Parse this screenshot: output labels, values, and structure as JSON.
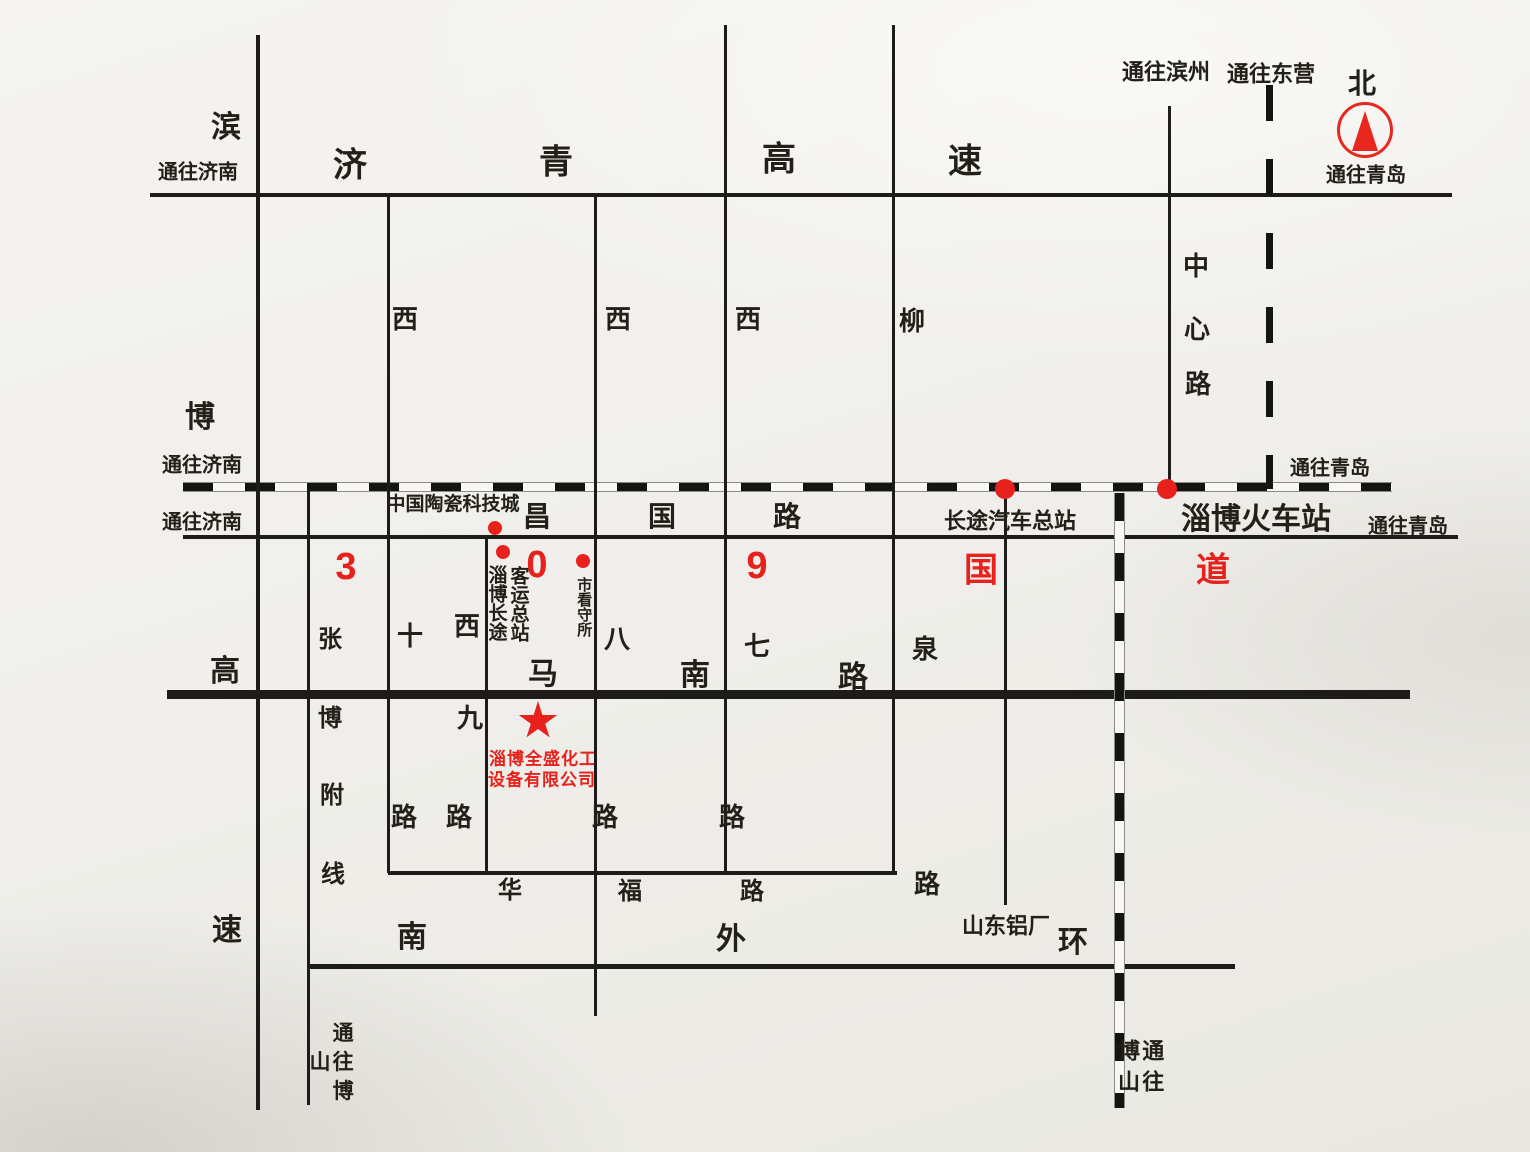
{
  "meta": {
    "title": "淄博全盛化工设备有限公司 位置示意图",
    "type": "location-sketch-map"
  },
  "palette": {
    "line": "#1d1c1a",
    "red": "#e8211d",
    "background": "#f0efeb"
  },
  "compass": {
    "label": "北",
    "x": 1365,
    "y": 130,
    "r": 27
  },
  "roads": {
    "horizontal": [
      {
        "n": "jiqing-expressway",
        "y": 195,
        "x1": 150,
        "x2": 1452,
        "th": 4
      },
      {
        "n": "railway-g309",
        "y": 486,
        "x1": 183,
        "x2": 1392,
        "th": 8,
        "style": "railway"
      },
      {
        "n": "changguo-road",
        "y": 537,
        "x1": 183,
        "x2": 1458,
        "th": 4
      },
      {
        "n": "manan-road",
        "y": 694,
        "x1": 167,
        "x2": 1410,
        "th": 9
      },
      {
        "n": "huafu-road",
        "y": 873,
        "x1": 388,
        "x2": 897,
        "th": 4
      },
      {
        "n": "south-outer-ring",
        "y": 966,
        "x1": 308,
        "x2": 1235,
        "th": 5
      }
    ],
    "vertical": [
      {
        "n": "binbo-expressway",
        "x": 258,
        "y1": 35,
        "y2": 1110,
        "th": 4
      },
      {
        "n": "zhangbo-branch-line",
        "x": 308,
        "y1": 489,
        "y2": 1105,
        "th": 3
      },
      {
        "n": "west-10th-road",
        "x": 388,
        "y1": 195,
        "y2": 873,
        "th": 3
      },
      {
        "n": "west-9th-road",
        "x": 486,
        "y1": 537,
        "y2": 873,
        "th": 3
      },
      {
        "n": "west-8th-road",
        "x": 595,
        "y1": 195,
        "y2": 1016,
        "th": 3
      },
      {
        "n": "west-7th-road",
        "x": 725,
        "y1": 25,
        "y2": 873,
        "th": 3
      },
      {
        "n": "liuquan-road",
        "x": 893,
        "y1": 25,
        "y2": 875,
        "th": 3
      },
      {
        "n": "bus-terminal-spur",
        "x": 1005,
        "y1": 489,
        "y2": 905,
        "th": 3
      },
      {
        "n": "zhongxin-road",
        "x": 1169,
        "y1": 106,
        "y2": 489,
        "th": 3
      },
      {
        "n": "railway-south",
        "x": 1118,
        "y1": 493,
        "y2": 1108,
        "th": 9,
        "style": "railway"
      },
      {
        "n": "dongying-road",
        "x": 1269,
        "y1": 85,
        "y2": 489,
        "th": 7,
        "style": "dashed"
      }
    ]
  },
  "labels": [
    {
      "t": "通往济南",
      "x": 198,
      "y": 173,
      "s": 20,
      "n": "to-jinan-north"
    },
    {
      "t": "滨",
      "x": 226,
      "y": 128,
      "s": 30,
      "n": "binbo-expwy-char-1"
    },
    {
      "t": "博",
      "x": 200,
      "y": 418,
      "s": 30,
      "n": "binbo-expwy-char-2"
    },
    {
      "t": "高",
      "x": 225,
      "y": 672,
      "s": 30,
      "n": "binbo-expwy-char-3"
    },
    {
      "t": "速",
      "x": 227,
      "y": 931,
      "s": 30,
      "n": "binbo-expwy-char-4"
    },
    {
      "t": "济",
      "x": 350,
      "y": 166,
      "s": 34,
      "n": "jiqing-expwy-char-1"
    },
    {
      "t": "青",
      "x": 556,
      "y": 163,
      "s": 34,
      "n": "jiqing-expwy-char-2"
    },
    {
      "t": "高",
      "x": 779,
      "y": 160,
      "s": 34,
      "n": "jiqing-expwy-char-3"
    },
    {
      "t": "速",
      "x": 965,
      "y": 162,
      "s": 34,
      "n": "jiqing-expwy-char-4"
    },
    {
      "t": "通往滨州",
      "x": 1166,
      "y": 72,
      "s": 22,
      "n": "to-binzhou"
    },
    {
      "t": "通往东营",
      "x": 1271,
      "y": 74,
      "s": 22,
      "n": "to-dongying"
    },
    {
      "t": "北",
      "x": 1362,
      "y": 84,
      "s": 28,
      "n": "north-label"
    },
    {
      "t": "通往青岛",
      "x": 1366,
      "y": 176,
      "s": 20,
      "n": "to-qingdao-top"
    },
    {
      "t": "西",
      "x": 405,
      "y": 320,
      "s": 26,
      "n": "west10-char-xi"
    },
    {
      "t": "十",
      "x": 410,
      "y": 637,
      "s": 26,
      "n": "west10-char-shi"
    },
    {
      "t": "路",
      "x": 404,
      "y": 818,
      "s": 26,
      "n": "west10-char-lu"
    },
    {
      "t": "西",
      "x": 467,
      "y": 627,
      "s": 26,
      "n": "west9-char-xi"
    },
    {
      "t": "九",
      "x": 470,
      "y": 719,
      "s": 26,
      "n": "west9-char-jiu"
    },
    {
      "t": "路",
      "x": 459,
      "y": 818,
      "s": 26,
      "n": "west9-char-lu"
    },
    {
      "t": "西",
      "x": 618,
      "y": 320,
      "s": 26,
      "n": "west8-char-xi"
    },
    {
      "t": "八",
      "x": 617,
      "y": 640,
      "s": 26,
      "n": "west8-char-ba"
    },
    {
      "t": "路",
      "x": 605,
      "y": 818,
      "s": 26,
      "n": "west8-char-lu"
    },
    {
      "t": "西",
      "x": 748,
      "y": 320,
      "s": 26,
      "n": "west7-char-xi"
    },
    {
      "t": "七",
      "x": 757,
      "y": 647,
      "s": 26,
      "n": "west7-char-qi"
    },
    {
      "t": "路",
      "x": 732,
      "y": 818,
      "s": 26,
      "n": "west7-char-lu"
    },
    {
      "t": "柳",
      "x": 912,
      "y": 322,
      "s": 26,
      "n": "liuquan-char-liu"
    },
    {
      "t": "泉",
      "x": 925,
      "y": 650,
      "s": 26,
      "n": "liuquan-char-quan"
    },
    {
      "t": "路",
      "x": 927,
      "y": 885,
      "s": 26,
      "n": "liuquan-char-lu"
    },
    {
      "t": "中",
      "x": 1196,
      "y": 267,
      "s": 26,
      "n": "zhongxin-char-1"
    },
    {
      "t": "心",
      "x": 1197,
      "y": 330,
      "s": 26,
      "n": "zhongxin-char-2"
    },
    {
      "t": "路",
      "x": 1198,
      "y": 385,
      "s": 26,
      "n": "zhongxin-char-3"
    },
    {
      "t": "通往济南",
      "x": 202,
      "y": 466,
      "s": 20,
      "n": "to-jinan-railway"
    },
    {
      "t": "通往济南",
      "x": 202,
      "y": 523,
      "s": 20,
      "n": "to-jinan-changguo"
    },
    {
      "t": "通往青岛",
      "x": 1330,
      "y": 469,
      "s": 20,
      "n": "to-qingdao-railway"
    },
    {
      "t": "通往青岛",
      "x": 1408,
      "y": 527,
      "s": 20,
      "n": "to-qingdao-changguo"
    },
    {
      "t": "中国陶瓷科技城",
      "x": 453,
      "y": 505,
      "s": 19,
      "n": "ceramics-city-label"
    },
    {
      "t": "昌",
      "x": 537,
      "y": 517,
      "s": 28,
      "n": "changguo-char-1"
    },
    {
      "t": "国",
      "x": 662,
      "y": 517,
      "s": 28,
      "n": "changguo-char-2"
    },
    {
      "t": "路",
      "x": 787,
      "y": 517,
      "s": 28,
      "n": "changguo-char-3"
    },
    {
      "t": "长途汽车总站",
      "x": 1010,
      "y": 521,
      "s": 22,
      "n": "bus-terminal-label"
    },
    {
      "t": "淄博火车站",
      "x": 1256,
      "y": 520,
      "s": 30,
      "w": 700,
      "n": "railway-station-label"
    },
    {
      "t": "3",
      "x": 346,
      "y": 568,
      "s": 38,
      "c": "red",
      "w": 700,
      "n": "g309-char-3"
    },
    {
      "t": "0",
      "x": 537,
      "y": 566,
      "s": 38,
      "c": "red",
      "w": 700,
      "n": "g309-char-0"
    },
    {
      "t": "9",
      "x": 757,
      "y": 567,
      "s": 38,
      "c": "red",
      "w": 700,
      "n": "g309-char-9"
    },
    {
      "t": "国",
      "x": 981,
      "y": 571,
      "s": 34,
      "c": "red",
      "w": 700,
      "n": "g309-char-guo"
    },
    {
      "t": "道",
      "x": 1213,
      "y": 571,
      "s": 34,
      "c": "red",
      "w": 700,
      "n": "g309-char-dao"
    },
    {
      "t": "淄博长途",
      "x": 495,
      "y": 603,
      "s": 19,
      "v": 1,
      "n": "coach-terminal-label-col1"
    },
    {
      "t": "客运总站",
      "x": 517,
      "y": 604,
      "s": 19,
      "v": 1,
      "n": "coach-terminal-label-col2"
    },
    {
      "t": "市看守所",
      "x": 583,
      "y": 607,
      "s": 15,
      "v": 1,
      "n": "detention-house-label"
    },
    {
      "t": "张",
      "x": 330,
      "y": 640,
      "s": 24,
      "n": "zhangbo-char-1"
    },
    {
      "t": "博",
      "x": 330,
      "y": 719,
      "s": 24,
      "n": "zhangbo-char-2"
    },
    {
      "t": "附",
      "x": 332,
      "y": 796,
      "s": 24,
      "n": "zhangbo-char-3"
    },
    {
      "t": "线",
      "x": 333,
      "y": 875,
      "s": 24,
      "n": "zhangbo-char-4"
    },
    {
      "t": "马",
      "x": 543,
      "y": 675,
      "s": 30,
      "n": "manan-char-ma"
    },
    {
      "t": "南",
      "x": 695,
      "y": 676,
      "s": 30,
      "n": "manan-char-nan"
    },
    {
      "t": "路",
      "x": 853,
      "y": 678,
      "s": 30,
      "n": "manan-char-lu"
    },
    {
      "t": "华",
      "x": 510,
      "y": 891,
      "s": 24,
      "n": "huafu-char-1"
    },
    {
      "t": "福",
      "x": 630,
      "y": 892,
      "s": 24,
      "n": "huafu-char-2"
    },
    {
      "t": "路",
      "x": 752,
      "y": 892,
      "s": 24,
      "n": "huafu-char-3"
    },
    {
      "t": "山东铝厂",
      "x": 1006,
      "y": 926,
      "s": 22,
      "n": "shandong-aluminum-label"
    },
    {
      "t": "南",
      "x": 412,
      "y": 938,
      "s": 30,
      "n": "ring-char-nan"
    },
    {
      "t": "外",
      "x": 731,
      "y": 940,
      "s": 30,
      "n": "ring-char-wai"
    },
    {
      "t": "环",
      "x": 1073,
      "y": 943,
      "s": 30,
      "n": "ring-char-huan"
    },
    {
      "t": "通往博山",
      "x": 330,
      "y": 1065,
      "s": 21,
      "v": 1,
      "ls": 8,
      "n": "to-boshan-west"
    },
    {
      "t": "通往博山",
      "x": 1139,
      "y": 1070,
      "s": 22,
      "v": 1,
      "ls": 9,
      "n": "to-boshan-railway"
    }
  ],
  "dots": [
    {
      "x": 495,
      "y": 528,
      "r": 7,
      "n": "dot-ceramics-city"
    },
    {
      "x": 503,
      "y": 552,
      "r": 7,
      "n": "dot-coach-terminal"
    },
    {
      "x": 583,
      "y": 561,
      "r": 7,
      "n": "dot-detention-house"
    },
    {
      "x": 1005,
      "y": 489,
      "r": 10,
      "n": "dot-bus-terminal"
    },
    {
      "x": 1167,
      "y": 489,
      "r": 10,
      "n": "dot-railway-station"
    }
  ],
  "company": {
    "star": {
      "x": 538,
      "y": 721,
      "size": 40
    },
    "line1": "淄博全盛化工",
    "line2": "设备有限公司",
    "line1_pos": {
      "x": 543,
      "y": 757
    },
    "line2_pos": {
      "x": 542,
      "y": 778
    }
  }
}
